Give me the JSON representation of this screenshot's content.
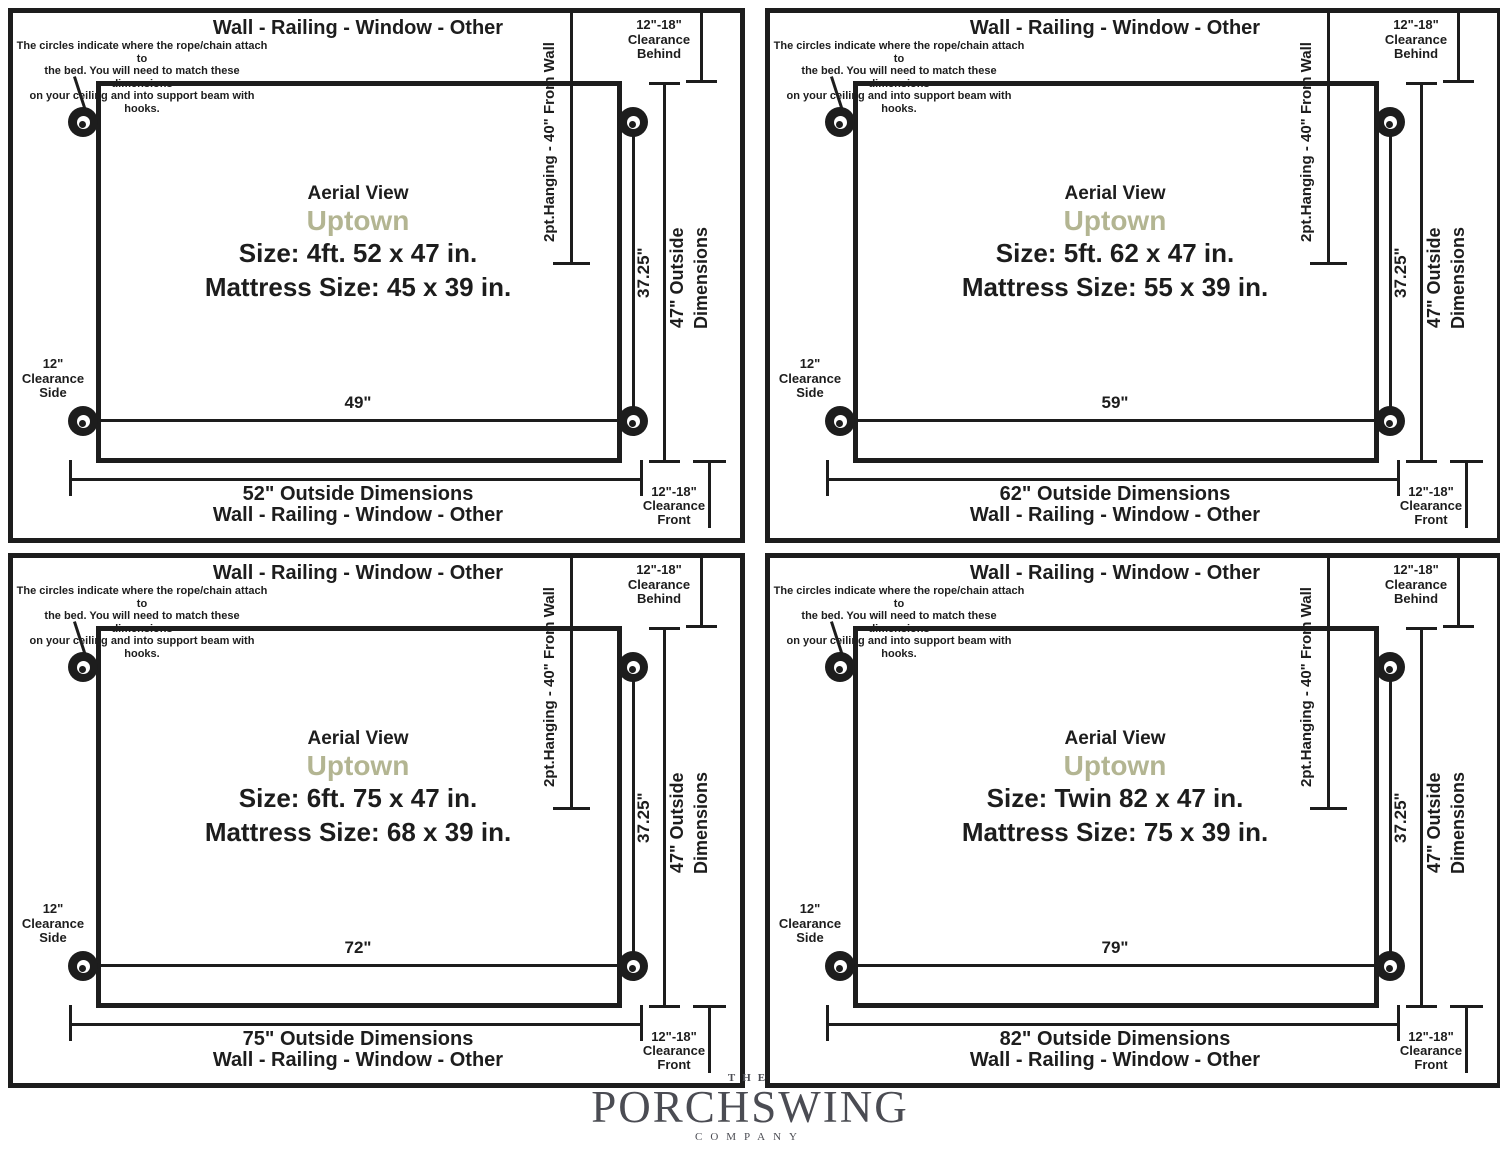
{
  "colors": {
    "ink": "#1d1d1d",
    "model_accent": "#b3b592",
    "logo": "#4b4c53"
  },
  "shared": {
    "wall_label": "Wall - Railing - Window - Other",
    "note_line1": "The circles indicate where the rope/chain attach to",
    "note_line2": "the bed. You will need to match these dimensions",
    "note_line3": "on your ceiling and into support beam with hooks.",
    "clearance_behind_l1": "12\"-18\"",
    "clearance_behind_l2": "Clearance",
    "clearance_behind_l3": "Behind",
    "clearance_front_l1": "12\"-18\"",
    "clearance_front_l2": "Clearance",
    "clearance_front_l3": "Front",
    "clearance_side_l1": "12\"",
    "clearance_side_l2": "Clearance",
    "clearance_side_l3": "Side",
    "hanging_label": "2pt.Hanging - 40\" From Wall",
    "aerial_label": "Aerial View",
    "model_name": "Uptown",
    "attach_depth_label": "37.25\"",
    "outside_depth_l1": "47\" Outside",
    "outside_depth_l2": "Dimensions"
  },
  "panels": [
    {
      "size_label": "Size: 4ft. 52 x 47 in.",
      "mattress_label": "Mattress Size: 45 x 39 in.",
      "attach_width_label": "49\"",
      "outside_width_label": "52\" Outside Dimensions"
    },
    {
      "size_label": "Size: 5ft. 62 x 47 in.",
      "mattress_label": "Mattress Size: 55 x 39 in.",
      "attach_width_label": "59\"",
      "outside_width_label": "62\" Outside Dimensions"
    },
    {
      "size_label": "Size: 6ft. 75 x 47 in.",
      "mattress_label": "Mattress Size: 68 x 39 in.",
      "attach_width_label": "72\"",
      "outside_width_label": "75\" Outside Dimensions"
    },
    {
      "size_label": "Size: Twin 82 x 47 in.",
      "mattress_label": "Mattress Size: 75 x 39 in.",
      "attach_width_label": "79\"",
      "outside_width_label": "82\" Outside Dimensions"
    }
  ],
  "logo": {
    "the": "THE",
    "name": "PORCHSWING",
    "company": "COMPANY"
  }
}
